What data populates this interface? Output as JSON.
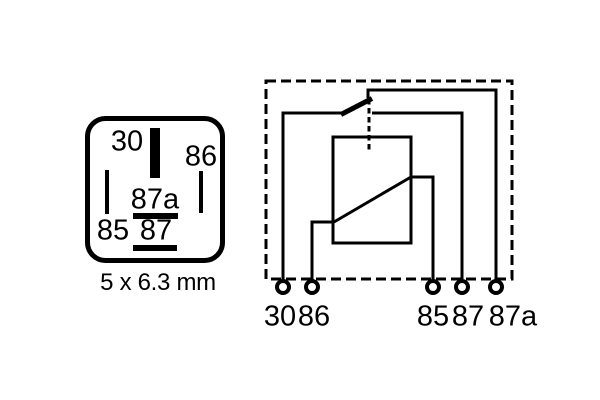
{
  "figure": {
    "description": "Relay pin footprint and internal circuit schematic",
    "background_color": "#ffffff",
    "line_color": "#000000"
  },
  "pinout": {
    "labels": {
      "p30": "30",
      "p86": "86",
      "p85": "85",
      "p87a": "87a",
      "p87": "87"
    },
    "size_label": "5 x 6.3 mm"
  },
  "schematic": {
    "terminals": [
      {
        "id": "30",
        "label": "30"
      },
      {
        "id": "86",
        "label": "86"
      },
      {
        "id": "85",
        "label": "85"
      },
      {
        "id": "87",
        "label": "87"
      },
      {
        "id": "87a",
        "label": "87a"
      }
    ]
  }
}
